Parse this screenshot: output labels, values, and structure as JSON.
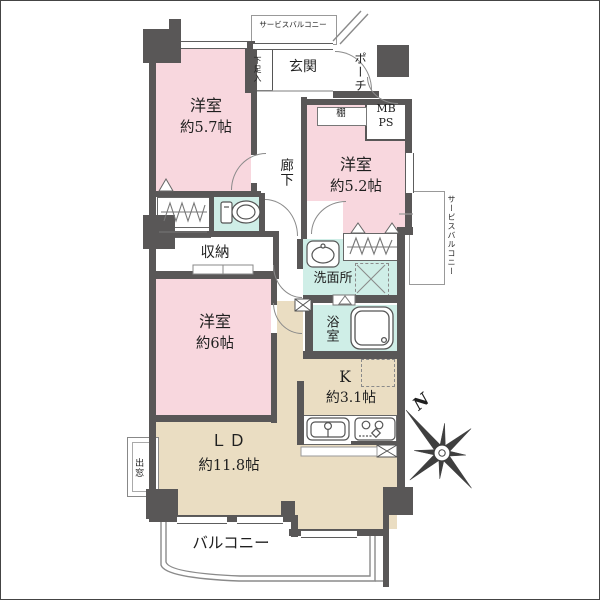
{
  "floorplan": {
    "rooms": {
      "bedroom_57": {
        "name": "洋室",
        "size": "約5.7帖"
      },
      "bedroom_52": {
        "name": "洋室",
        "size": "約5.2帖"
      },
      "bedroom_6": {
        "name": "洋室",
        "size": "約6帖"
      },
      "kitchen": {
        "name": "K",
        "size": "約3.1帖"
      },
      "living_dining": {
        "name": "ＬＤ",
        "size": "約11.8帖"
      }
    },
    "labels": {
      "service_balcony_top": "サービスバルコニー",
      "service_balcony_right": "サービスバルコニー",
      "shoe_cabinet": "下足入",
      "entrance": "玄関",
      "porch": "ポーチ",
      "shelf": "棚",
      "mb": "MB",
      "ps": "PS",
      "corridor": "廊下",
      "storage": "収納",
      "washroom": "洗面所",
      "bathroom": "浴室",
      "bay_window": "出窓",
      "balcony": "バルコニー"
    },
    "compass": {
      "north": "N"
    },
    "colors": {
      "bedroom_pink": "#f8d7de",
      "wet_area_teal": "#cfeee7",
      "living_beige": "#eaddc2",
      "wall_gray": "#595757",
      "outline_gray": "#8a8a8a"
    }
  }
}
